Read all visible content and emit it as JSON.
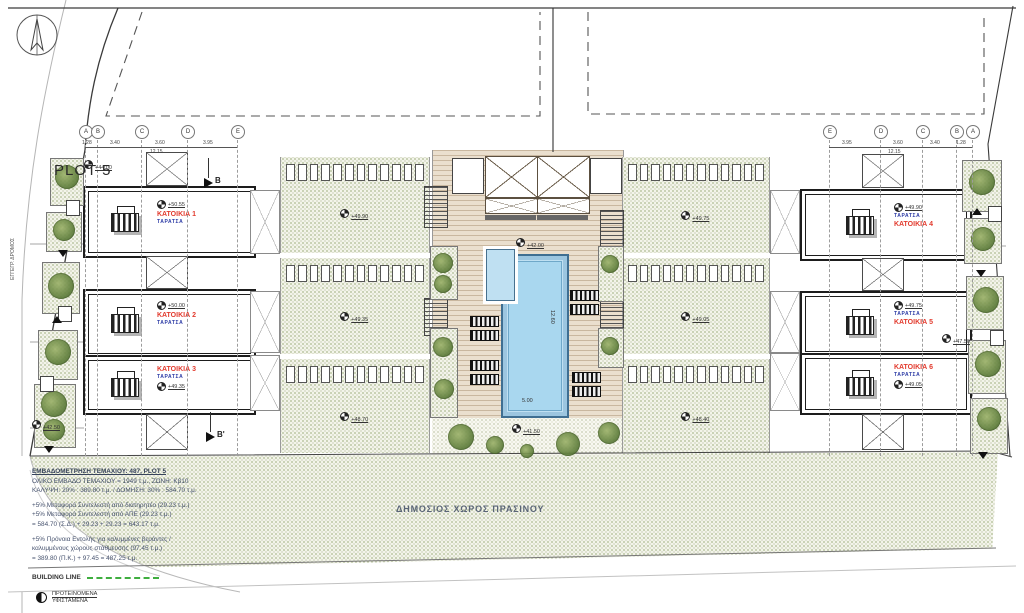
{
  "plot_label": "PLOT 5",
  "road_label": "ΕΓΓΕΓΡ. ΔΡΟΜΟΣ",
  "grid_left": {
    "letters": [
      "A",
      "B",
      "C",
      "D",
      "E"
    ],
    "dims": [
      "1.28",
      "3.40",
      "3.60",
      "3.95"
    ],
    "total": "12.15"
  },
  "grid_right": {
    "letters": [
      "E",
      "D",
      "C",
      "B",
      "A"
    ],
    "dims": [
      "3.95",
      "3.60",
      "3.40",
      "1.28"
    ],
    "total": "12.15"
  },
  "houses": [
    {
      "name": "ΚΑΤΟΙΚΙΑ 1",
      "roof": "ΤΑΡΑΤΣΑ",
      "level": "+50.55"
    },
    {
      "name": "ΚΑΤΟΙΚΙΑ 2",
      "roof": "ΤΑΡΑΤΣΑ",
      "level": "+50.00"
    },
    {
      "name": "ΚΑΤΟΙΚΙΑ 3",
      "roof": "ΤΑΡΑΤΣΑ",
      "level": "+49.35"
    },
    {
      "name": "ΚΑΤΟΙΚΙΑ 4",
      "roof": "ΤΑΡΑΤΣΑ",
      "level": "+49.90"
    },
    {
      "name": "ΚΑΤΟΙΚΙΑ 5",
      "roof": "ΤΑΡΑΤΣΑ",
      "level": "+49.75"
    },
    {
      "name": "ΚΑΤΟΙΚΙΑ 6",
      "roof": "ΤΑΡΑΤΣΑ",
      "level": "+49.05"
    }
  ],
  "roof_levels": [
    "+49.90",
    "+49.35",
    "+48.70",
    "+49.75",
    "+49.05",
    "+48.40"
  ],
  "courtyard": {
    "deck_level": "+42.00",
    "garden_level": "+41.50",
    "pool_width": "5.00",
    "pool_length": "12.60"
  },
  "sections": {
    "b": "B",
    "b_prime": "B'"
  },
  "edge_levels": {
    "left_top": "+44.00",
    "left_bottom": "+42.50",
    "right_mid": "+47.50"
  },
  "public_green": "ΔΗΜΟΣΙΟΣ ΧΩΡΟΣ ΠΡΑΣΙΝΟΥ",
  "notes": {
    "l1": "ΕΜΒΑΔΟΜΕΤΡΗΣΗ ΤΕΜΑΧΙΟΥ: 487, PLOT 5",
    "l2": "ΟΛΙΚΟ ΕΜΒΑΔΟ ΤΕΜΑΧΙΟΥ = 1949 τ.μ., ΖΩΝΗ: Κβ10",
    "l3": "ΚΑΛΥΨΗ: 20% : 389.80 τ.μ. / ΔΟΜΗΣΗ: 30% : 584.70 τ.μ.",
    "l4": "+5% Μεταφορά Συντελεστή από διατηρητέο (29.23 τ.μ.)",
    "l5": "+5% Μεταφορά Συντελεστή από ΑΠΕ (29.23 τ.μ.)",
    "l6": "= 584.70 (Σ.Δ.) + 29.23 + 29.23 = 643.17 τ.μ.",
    "l7": "+5% Πρόνοια Εντολής για καλυμμένες βεράντες /",
    "l8": "καλυμμένους χώρους στάθμευσης (97.45 τ.μ.)",
    "l9": "= 389.80 (Π.Κ.) + 97.45 = 487.25 τ.μ.",
    "building_line": "BUILDING LINE"
  },
  "legend": {
    "proposed": "ΠΡΟΤΕΙΝΟΜΕΝΑ",
    "existing": "ΥΦΙΣΤΑΜΕΝΑ"
  }
}
